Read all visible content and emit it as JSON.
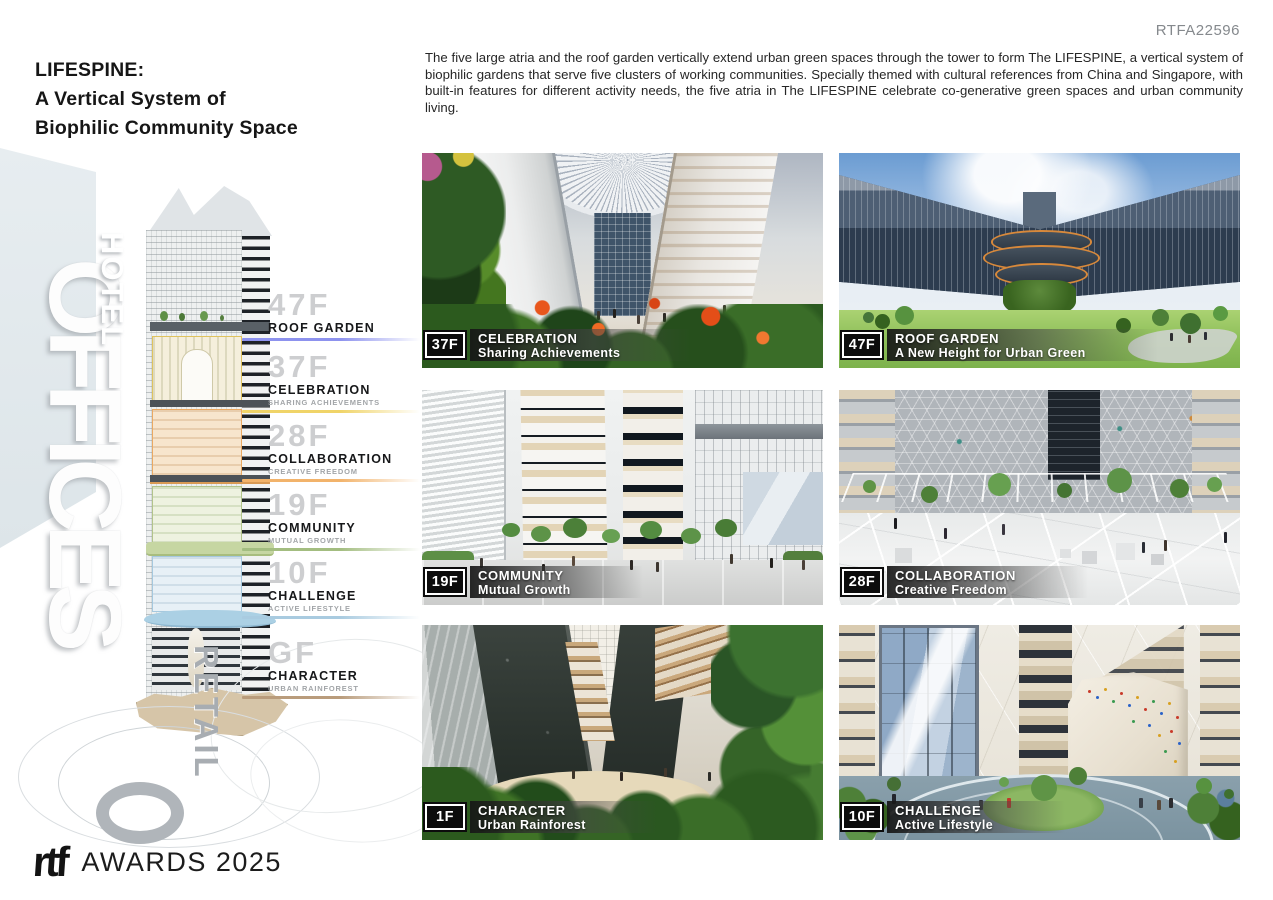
{
  "page": {
    "id_code": "RTFA22596"
  },
  "header": {
    "title_line1": "LIFESPINE:",
    "title_line2": "A Vertical System of",
    "title_line3": "Biophilic Community Space",
    "description": "The five large atria and the roof garden vertically extend urban green spaces through the tower to form The LIFESPINE, a vertical system of biophilic gardens that serve five clusters of working communities. Specially themed with cultural references from China and Singapore, with built-in features for different activity needs, the five atria in The LIFESPINE celebrate co-generative green spaces and urban community living."
  },
  "tower_diagram": {
    "watermarks": {
      "hotel": "HOTEL",
      "offices": "OFFICES",
      "retail": "RETAIL"
    },
    "floor_labels": [
      {
        "floor": "47F",
        "name": "ROOF GARDEN",
        "subtitle": "",
        "accent": "#8d92ee"
      },
      {
        "floor": "37F",
        "name": "CELEBRATION",
        "subtitle": "SHARING ACHIEVEMENTS",
        "accent": "#f0d468"
      },
      {
        "floor": "28F",
        "name": "COLLABORATION",
        "subtitle": "CREATIVE FREEDOM",
        "accent": "#f2b36b"
      },
      {
        "floor": "19F",
        "name": "COMMUNITY",
        "subtitle": "MUTUAL GROWTH",
        "accent": "#a3bd80"
      },
      {
        "floor": "10F",
        "name": "CHALLENGE",
        "subtitle": "ACTIVE LIFESTYLE",
        "accent": "#a9cbe0"
      },
      {
        "floor": "GF",
        "name": "CHARACTER",
        "subtitle": "URBAN RAINFOREST",
        "accent": "#b99c7c"
      }
    ]
  },
  "panels": [
    {
      "floor": "37F",
      "title": "CELEBRATION",
      "subtitle": "Sharing Achievements"
    },
    {
      "floor": "47F",
      "title": "ROOF GARDEN",
      "subtitle": "A New Height for Urban Green"
    },
    {
      "floor": "19F",
      "title": "COMMUNITY",
      "subtitle": "Mutual Growth"
    },
    {
      "floor": "28F",
      "title": "COLLABORATION",
      "subtitle": "Creative Freedom"
    },
    {
      "floor": "1F",
      "title": "CHARACTER",
      "subtitle": "Urban Rainforest"
    },
    {
      "floor": "10F",
      "title": "CHALLENGE",
      "subtitle": "Active Lifestyle"
    }
  ],
  "footer": {
    "logo": "rtf",
    "awards_text": "AWARDS 2025"
  }
}
